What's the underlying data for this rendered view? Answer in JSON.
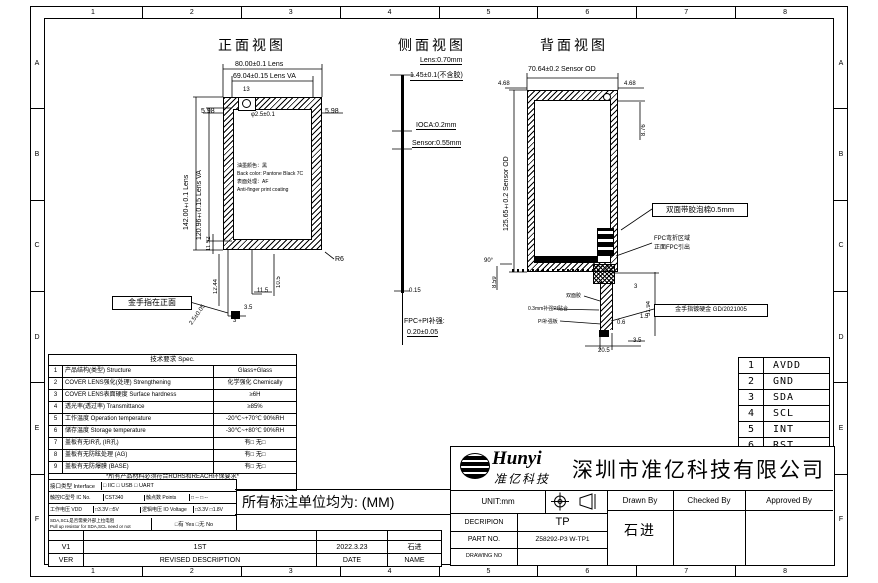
{
  "frame": {
    "cols": [
      "1",
      "2",
      "3",
      "4",
      "5",
      "6",
      "7",
      "8"
    ],
    "rows": [
      "A",
      "B",
      "C",
      "D",
      "E",
      "F"
    ]
  },
  "front_view": {
    "title": "正面视图",
    "dim_width_lens": "80.00±0.1 Lens",
    "dim_width_va": "69.04±0.15 Lens VA",
    "dim_height_lens": "142.00±0.1 Lens",
    "dim_height_va": "120.96±0.15 Lens VA",
    "dim_left_598": "5.98",
    "dim_right_598": "5.98",
    "dim_13": "13",
    "hole_label": "φ2.5±0.1",
    "note_lines": [
      "油墨颜色：黑",
      "Back color: Pantone Black 7C",
      "表面处理：AF",
      "Anti-finger print coating"
    ],
    "corner_r": "R6",
    "dim_1152": "11.52",
    "dim_1244": "12.44",
    "dim_105": "10.5",
    "dim_115": "11.5",
    "dim_35": "3.5",
    "dim_3": "3",
    "dim_25": "2.5±0.05",
    "callout_gold": "金手指在正面"
  },
  "side_view": {
    "title": "侧面视图",
    "label_lens": "Lens:0.70mm",
    "label_total": "1.45±0.1(不含胶)",
    "label_oca": "IOCA:0.2mm",
    "label_sensor": "Sensor:0.55mm",
    "dim_015": "0.15",
    "label_fpc1": "FPC+PI补强:",
    "label_fpc2": "0.20±0.05"
  },
  "back_view": {
    "title": "背面视图",
    "dim_top": "70.64±0.2 Sensor OD",
    "dim_468_l": "4.68",
    "dim_468_r": "4.68",
    "dim_876": "8.76",
    "dim_height": "125.65±0.2 Sensor OD",
    "callout_foam": "双面带胶泡棉0.5mm",
    "label_bend_1": "FPC弯折区域",
    "label_bend_2": "正面FPC引出",
    "dim_859": "8.59",
    "dim_90": "90°",
    "dim_3": "3",
    "dim_5194": "51.94",
    "dim_15": "1.5",
    "dim_06": "0.6",
    "dim_35": "3.5",
    "dim_205": "20.5",
    "label_tape": "双面胶",
    "label_pi": "0.3mm补强PI贴合",
    "label_stiffener": "PI补强板",
    "callout_gold": "金手指镀硬金 GD/2021005"
  },
  "spec_table": {
    "title": "技术要求 Spec.",
    "rows": [
      {
        "no": "1",
        "name": "产品结构(类型) Structure",
        "value": "Glass+Glass"
      },
      {
        "no": "2",
        "name": "COVER LENS强化(处理) Strengthening",
        "value": "化学强化 Chemically"
      },
      {
        "no": "3",
        "name": "COVER LENS表面硬度 Surface hardness",
        "value": "≥6H"
      },
      {
        "no": "4",
        "name": "透光率(透过率) Transmittance",
        "value": "≥85%"
      },
      {
        "no": "5",
        "name": "工作温度 Operation temperature",
        "value": "-20℃~+70℃ 90%RH"
      },
      {
        "no": "6",
        "name": "储存温度 Storage temperature",
        "value": "-30℃~+80℃ 90%RH"
      },
      {
        "no": "7",
        "name": "盖板有无IR孔 (IR孔)",
        "value": "有□  无□"
      },
      {
        "no": "8",
        "name": "盖板有无防眩处理 (AG)",
        "value": "有□  无□"
      },
      {
        "no": "9",
        "name": "盖板有无防爆膜 (BASE)",
        "value": "有□  无□"
      }
    ],
    "note1": "*所有产品材料必须符合ROHS和REACH环保要求*",
    "note2": "(All materials comply with RoHS & REACH requirement)",
    "interface_label": "接口类型 Interface",
    "interface_value": "□ IIC      □ USB      □ UART",
    "ic_label": "触控IC型号 IC No.",
    "ic_value": "CST340",
    "points_label": "触点数 Points",
    "points_value": "□ --  □ --",
    "vdd_label": "工作电压 VDD",
    "vdd_value": "□3.3V □5V",
    "io_label": "逻辑电压 IO Voltage",
    "io_value": "□3.3V □1.8V",
    "pullup_label1": "SDA,SCL是否需要外部上拉电阻",
    "pullup_label2": "Pull up resistor for SDA,SCL need or not",
    "pullup_value": "□有 Yes   □无 No"
  },
  "units_note": "所有标注单位均为: (MM)",
  "revision": {
    "rows": [
      {
        "ver": "V1",
        "desc": "1ST",
        "date": "2022.3.23",
        "name": "石进"
      }
    ],
    "header": {
      "ver": "VER",
      "desc": "REVISED DESCRIPTION",
      "date": "DATE",
      "name": "NAME"
    }
  },
  "pin_table": [
    {
      "no": "1",
      "name": "AVDD"
    },
    {
      "no": "2",
      "name": "GND"
    },
    {
      "no": "3",
      "name": "SDA"
    },
    {
      "no": "4",
      "name": "SCL"
    },
    {
      "no": "5",
      "name": "INT"
    },
    {
      "no": "6",
      "name": "RST"
    }
  ],
  "title_block": {
    "logo_text": "Hunyi",
    "logo_sub": "准亿科技",
    "company": "深圳市准亿科技有限公司",
    "unit_label": "UNIT:mm",
    "desc_label": "DECRIPION",
    "desc_value": "TP",
    "part_label": "PART NO.",
    "part_value": "Z58292-P3 W-TP1",
    "drawing_label": "DRAWING NO",
    "drawing_value": "",
    "drawn_label": "Drawn By",
    "checked_label": "Checked By",
    "approved_label": "Approved By",
    "drawn_value": "石进",
    "checked_value": "",
    "approved_value": ""
  }
}
